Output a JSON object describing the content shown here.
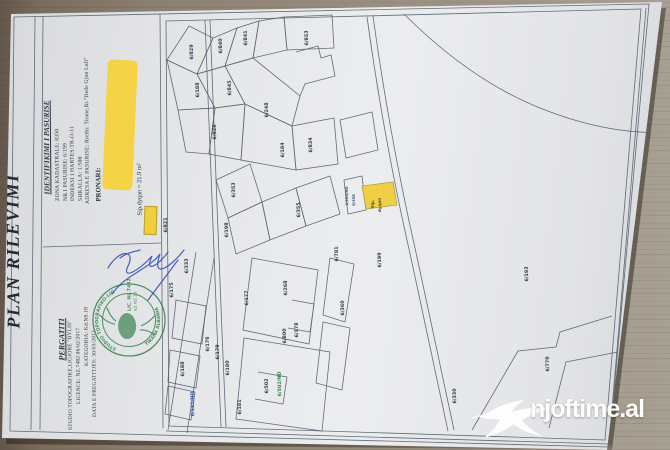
{
  "watermark": {
    "text": "njoftime.al"
  },
  "document": {
    "title": "PLAN RILEVIMI",
    "identification": {
      "heading": "IDENTIFIKIMI I PASURISE",
      "zona": "ZONA KADASTRALE: 8350",
      "pasuria": "NR.I PASURISE: 6/199",
      "indeksi": "INDEKSI I HARTES:TR-O-11",
      "shkalla": "SHKALLA: 1/500",
      "adresa": "ADRESA E PASURISE: Rrethi: Tirane,Rr.\"Dede Gjon Luli\"",
      "owner_label": "PRONARI:"
    },
    "legend": {
      "label": "Sip.dyqan = 21.9 m²",
      "swatch_color": "#f0cf3c"
    },
    "prepared_by": {
      "heading": "PERGATITI",
      "studio": "STUDIO TOPOGRAFIKE,LIGJORE \"BYLIS\"",
      "licence": "LICENCE: NZ.7482    96/02/2017",
      "kategoria": "KATEGORIA: Kd.NS.18",
      "data": "DATA E PREGATITJES: 30/03/2012"
    },
    "stamp": {
      "ring_top": "STUDIO TOPOGRAFIKO-LIGJORE",
      "ring_bottom": "TIRANA ALBANIA",
      "line1": "LIC. NL.7482",
      "line2": "Kd NS.18",
      "color": "#2e7d44"
    },
    "map": {
      "highlight": {
        "line1": "Sip.",
        "line2": "dyqan",
        "color": "#f0cf3c"
      },
      "parcels": [
        {
          "label": "6/829",
          "x": 193,
          "y": 52
        },
        {
          "label": "6/840",
          "x": 222,
          "y": 46
        },
        {
          "label": "6/841",
          "x": 247,
          "y": 38
        },
        {
          "label": "6/853",
          "x": 308,
          "y": 38
        },
        {
          "label": "6/188",
          "x": 199,
          "y": 90
        },
        {
          "label": "6/845",
          "x": 231,
          "y": 88
        },
        {
          "label": "6/248",
          "x": 268,
          "y": 110
        },
        {
          "label": "6/828",
          "x": 216,
          "y": 132
        },
        {
          "label": "6/184",
          "x": 284,
          "y": 150
        },
        {
          "label": "6/834",
          "x": 312,
          "y": 145
        },
        {
          "label": "6/353",
          "x": 235,
          "y": 190
        },
        {
          "label": "6/198",
          "x": 228,
          "y": 230
        },
        {
          "label": "6/355",
          "x": 300,
          "y": 210
        },
        {
          "label": "6/200/ND",
          "x": 348,
          "y": 196,
          "c": "sm"
        },
        {
          "label": "6/358",
          "x": 355,
          "y": 200,
          "c": "sm"
        },
        {
          "label": "6/821",
          "x": 167,
          "y": 225
        },
        {
          "label": "6/333",
          "x": 188,
          "y": 266
        },
        {
          "label": "6/175",
          "x": 173,
          "y": 290
        },
        {
          "label": "6/177",
          "x": 248,
          "y": 298
        },
        {
          "label": "6/268",
          "x": 287,
          "y": 288
        },
        {
          "label": "6/176",
          "x": 209,
          "y": 344
        },
        {
          "label": "6/179",
          "x": 219,
          "y": 352
        },
        {
          "label": "6/180",
          "x": 229,
          "y": 368
        },
        {
          "label": "6/188",
          "x": 184,
          "y": 369
        },
        {
          "label": "6/178",
          "x": 298,
          "y": 330
        },
        {
          "label": "6/800",
          "x": 286,
          "y": 336
        },
        {
          "label": "6/781",
          "x": 338,
          "y": 254
        },
        {
          "label": "6/360",
          "x": 344,
          "y": 308
        },
        {
          "label": "6/502",
          "x": 268,
          "y": 386
        },
        {
          "label": "6/502/ND",
          "x": 281,
          "y": 384,
          "c": "g"
        },
        {
          "label": "6/181",
          "x": 241,
          "y": 407
        },
        {
          "label": "6/151/ND",
          "x": 194,
          "y": 404,
          "c": "b"
        },
        {
          "label": "6/199",
          "x": 381,
          "y": 260,
          "s": 5.8
        },
        {
          "label": "6/193",
          "x": 528,
          "y": 274,
          "s": 5.8
        },
        {
          "label": "6/770",
          "x": 549,
          "y": 364
        },
        {
          "label": "6/330",
          "x": 456,
          "y": 396
        }
      ]
    }
  }
}
